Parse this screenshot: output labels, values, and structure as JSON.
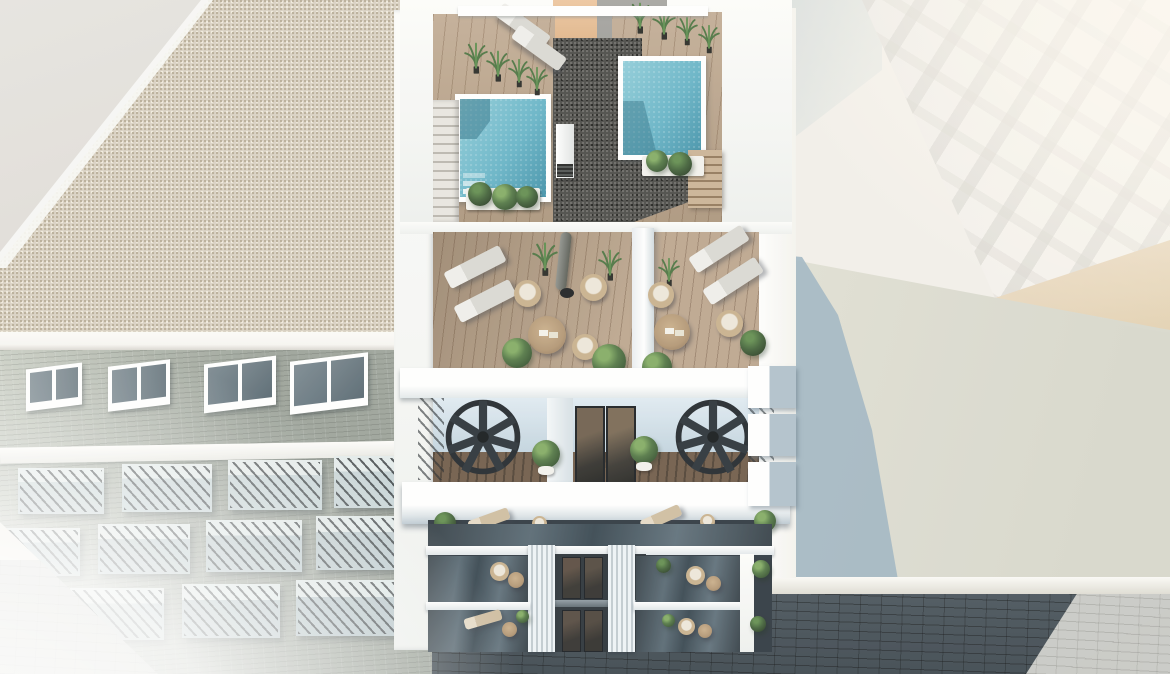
{
  "scene": {
    "type": "3d-architectural-render",
    "description": "Aerial bird's-eye rendering of a modern white apartment building with a rooftop featuring two turquoise plunge pools, wooden sun decks with loungers, wicker chairs, round tables, a closed parasol and potted plants; below are balcony levels with black spiral staircases and glass-fronted balconies, a gravel-roofed neighbouring block on the left with brick facade and railed balconies, an overexposed white residential facade on the right, a flat lower roof catching the tower's blue shadow, and a dark cobblestone street at the bottom.",
    "elements": [
      "left-building-gravel-roof",
      "left-building-brick-facade-with-balconies",
      "main-building-rooftop-two-pools",
      "rooftop-wood-deck-and-planters",
      "terrace-with-loungers-chairs-tables-parasol",
      "balcony-level-with-spiral-staircases",
      "lower-floors-glass-balconies-and-white-fins",
      "right-white-building-facade",
      "flat-roof-with-cast-shadow",
      "cobblestone-street-in-shadow"
    ]
  },
  "colors": {
    "hazeWhite": "#f2efe9",
    "planeGray": "#e2dfdb",
    "gravelBeige": "#d8d0c1",
    "gravelDot": "#b5a992",
    "fasciaWhite": "#f7f5f1",
    "brickGray": "#99a097",
    "windowDark": "#5c6d77",
    "balconyBlue": "#c6d3d6",
    "wallWhite": "#fbfbf8",
    "wallShadowBlue": "#bccfdb",
    "poolLight": "#8ccbd8",
    "poolDeep": "#3c8ea6",
    "deckWood": "#b89f84",
    "coreDark": "#454441",
    "terraceWood": "#b2997e",
    "loungerGray": "#d9d7d2",
    "wicker": "#c7ae89",
    "cushion": "#ece6d9",
    "tableWood": "#b09370",
    "bushGreen": "#4e7340",
    "palmGreen": "#578a48",
    "stairBlack": "#20262c",
    "glassDark": "#2e3941",
    "glassLight": "#53646f",
    "finWhite": "#eef3f6",
    "streetDark": "#3e4a53",
    "streetLight": "#c7c8c4",
    "roofShadowBlue": "#9db3c0",
    "roofLit": "#e0dfd3",
    "warmBeige": "#ead9c2",
    "orangeWall": "#edc49c",
    "grayWall": "#9d9c98"
  }
}
